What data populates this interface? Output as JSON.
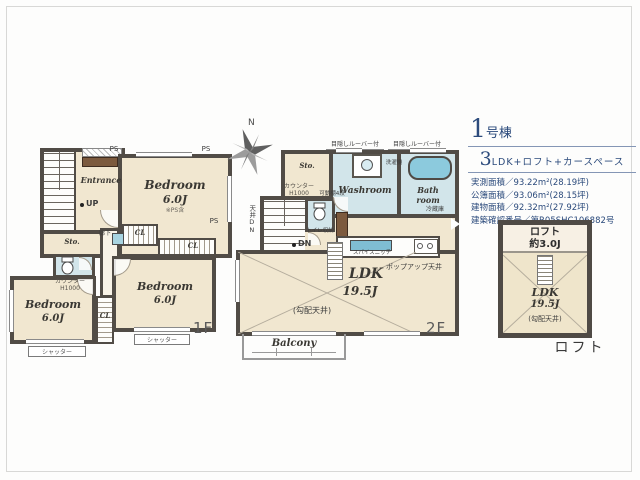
{
  "info_panel": {
    "building_number": "1",
    "building_suffix": "号棟",
    "layout_prefix": "3",
    "layout_text": "LDK+ロフト+カースペース",
    "specs": [
      "実測面積／93.22m²(28.19坪)",
      "公簿面積／93.06m²(28.15坪)",
      "建物面積／92.32m²(27.92坪)",
      "建築確認番号／第R05SHC106882号"
    ]
  },
  "floor1": {
    "label": "1F",
    "entrance": "Entrance",
    "up": "UP",
    "hallway": "廊下",
    "storage": "Sto.",
    "closet": "CL",
    "pipe_space": "PS",
    "shutter": "シャッター",
    "counter": "カウンター\nH1000",
    "bedroom_top": {
      "name": "Bedroom",
      "size": "6.0J",
      "note": "※PS含"
    },
    "bedroom_left": {
      "name": "Bedroom",
      "size": "6.0J"
    },
    "bedroom_mid": {
      "name": "Bedroom",
      "size": "6.0J"
    }
  },
  "floor2": {
    "label": "2F",
    "compass_north": "N",
    "louver_note": "目隠しルーバー付",
    "storage": "Sto.",
    "washer": "洗濯機",
    "washroom": "Washroom",
    "bathroom": "Bath\nroom",
    "counter": "カウンター\nH1000",
    "movable_shelf": "可動棚4段",
    "ceiling_dn": "天井DN",
    "toilet_storage": "トイレ収納",
    "down": "DN",
    "fridge": "冷蔵庫",
    "spice_niche": "スパイスニッチ",
    "popup_ceiling": "ポップアップ天井",
    "ldk": {
      "name": "LDK",
      "size": "19.5J"
    },
    "sloped_ceiling": "(勾配天井)",
    "balcony": "Balcony"
  },
  "loft": {
    "caption": "ロフト",
    "name": "ロフト",
    "size": "約3.0J",
    "ldk": {
      "name": "LDK",
      "size": "19.5J"
    },
    "sloped_ceiling": "(勾配天井)"
  }
}
